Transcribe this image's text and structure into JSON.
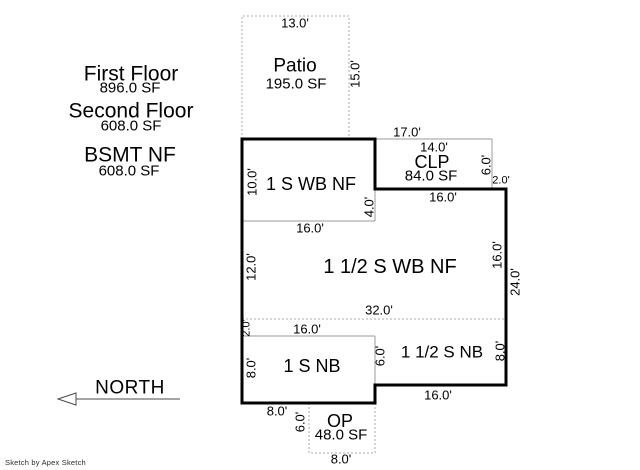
{
  "summary": [
    {
      "label": "First Floor",
      "sf": "896.0 SF"
    },
    {
      "label": "Second Floor",
      "sf": "608.0 SF"
    },
    {
      "label": "BSMT NF",
      "sf": "608.0 SF"
    }
  ],
  "areas": {
    "patio": {
      "label": "Patio",
      "sf": "195.0 SF"
    },
    "clp": {
      "label": "CLP",
      "sf": "84.0 SF"
    },
    "op": {
      "label": "OP",
      "sf": "48.0 SF"
    },
    "one_s_wb_nf": {
      "label": "1 S WB NF"
    },
    "one_half_s_wb_nf": {
      "label": "1 1/2 S WB NF"
    },
    "one_s_nb": {
      "label": "1 S NB"
    },
    "one_half_s_nb": {
      "label": "1 1/2 S NB"
    }
  },
  "dims": {
    "patio_top": "13.0'",
    "patio_right": "15.0'",
    "upper_overall": "17.0'",
    "clp_top": "14.0'",
    "clp_right": "6.0'",
    "clp_offset": "2.0'",
    "clp_bottom": "16.0'",
    "left_upper": "10.0'",
    "wb1_bottom": "16.0'",
    "wb1_right": "4.0'",
    "left_mid": "12.0'",
    "right_upper": "16.0'",
    "right_overall": "24.0'",
    "mid_width": "32.0'",
    "left_offset": "2.0'",
    "nb1_top": "16.0'",
    "left_lower": "8.0'",
    "nb_divider": "6.0'",
    "right_lower": "8.0'",
    "nb2_bottom": "16.0'",
    "bottom_left": "8.0'",
    "op_left": "6.0'",
    "op_bottom": "8.0'"
  },
  "north": {
    "label": "NORTH"
  },
  "footer": {
    "credit": "Sketch by Apex Sketch"
  },
  "colors": {
    "outline": "#000000",
    "interior_line": "#9b9b9b",
    "dotted_line": "#ababab",
    "text": "#000000",
    "background": "#ffffff"
  }
}
